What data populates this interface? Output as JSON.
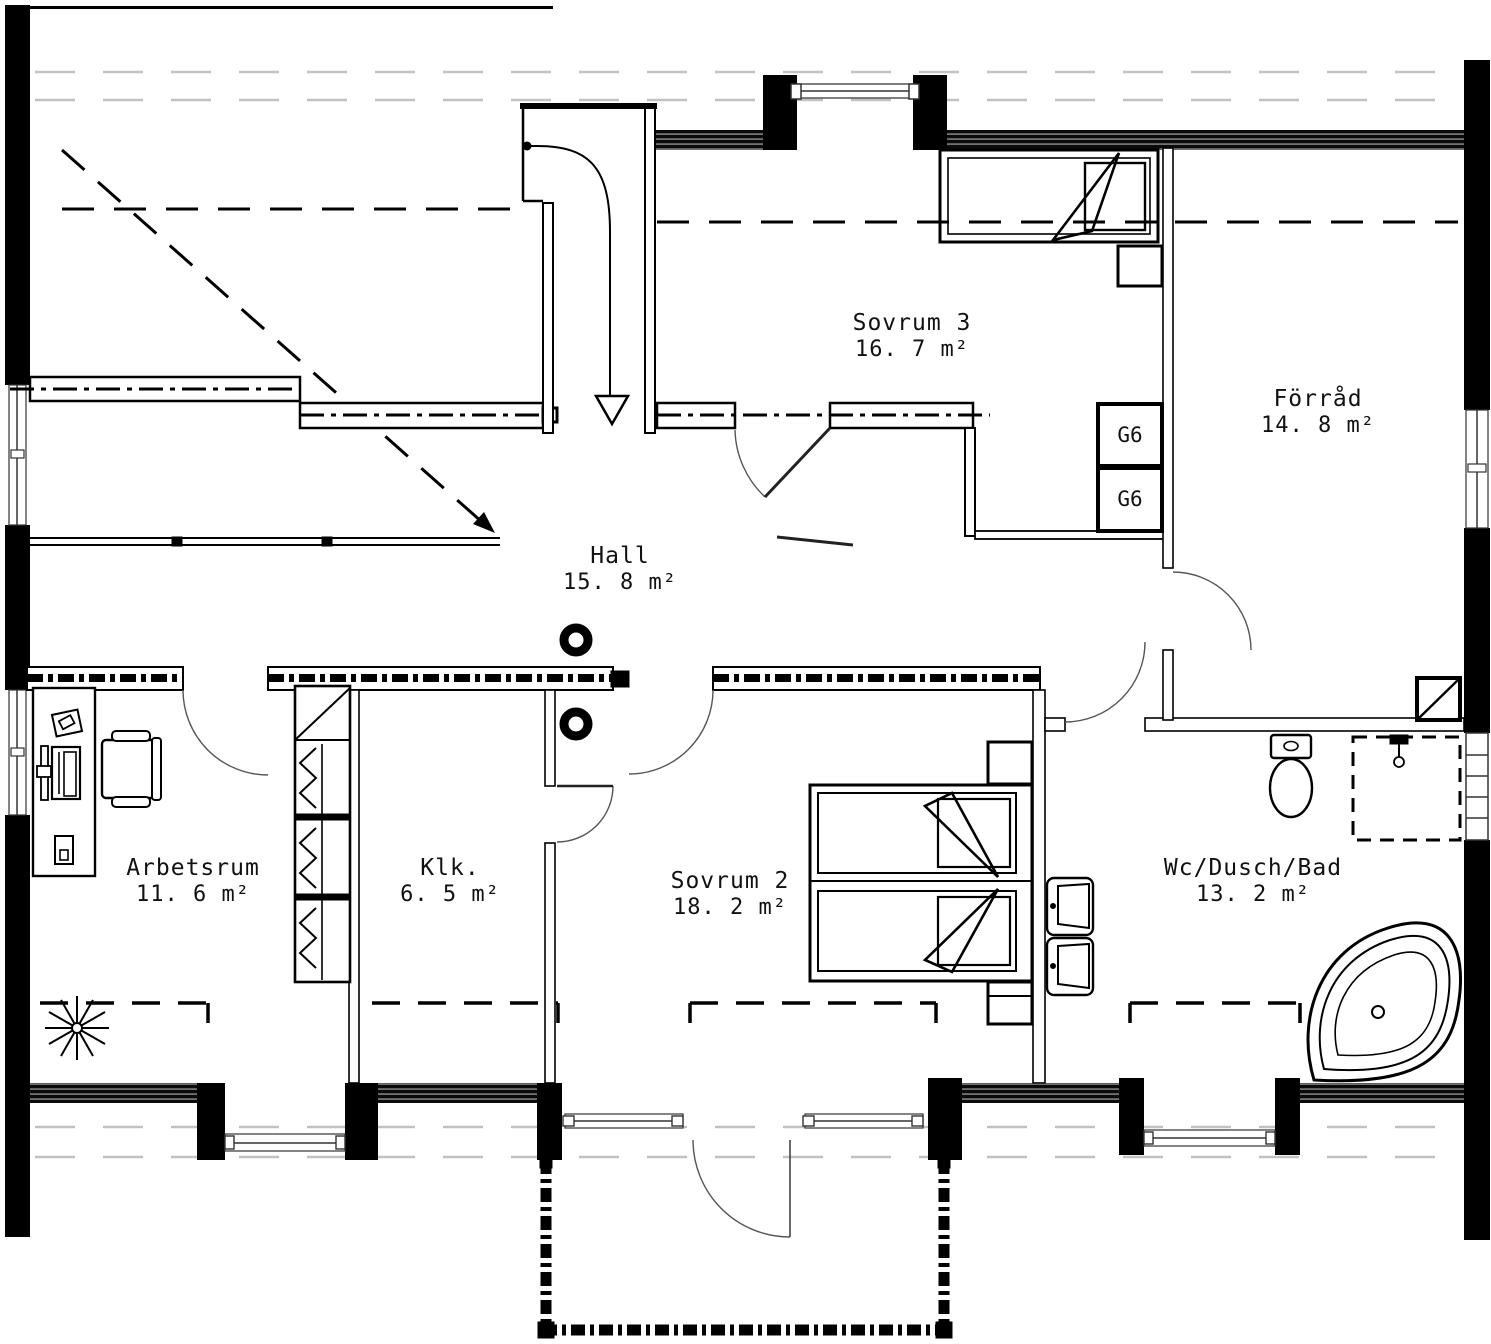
{
  "plan": {
    "title": "Floor plan - upper storey",
    "rooms": [
      {
        "id": "sovrum3",
        "label": "Sovrum 3",
        "area": "16. 7 m²"
      },
      {
        "id": "forrad",
        "label": "Förråd",
        "area": "14. 8 m²"
      },
      {
        "id": "hall",
        "label": "Hall",
        "area": "15. 8 m²"
      },
      {
        "id": "arbetsrum",
        "label": "Arbetsrum",
        "area": "11. 6 m²"
      },
      {
        "id": "klk",
        "label": "Klk.",
        "area": "6. 5 m²"
      },
      {
        "id": "sovrum2",
        "label": "Sovrum 2",
        "area": "18. 2 m²"
      },
      {
        "id": "wc",
        "label": "Wc/Dusch/Bad",
        "area": "13. 2 m²"
      }
    ],
    "cabinets": {
      "g6_top": "G6",
      "g6_bottom": "G6"
    },
    "colors": {
      "wall": "#000000",
      "line": "#1a1a1a",
      "roofline_light": "#c2c2c2",
      "door_arc": "#555555"
    }
  }
}
